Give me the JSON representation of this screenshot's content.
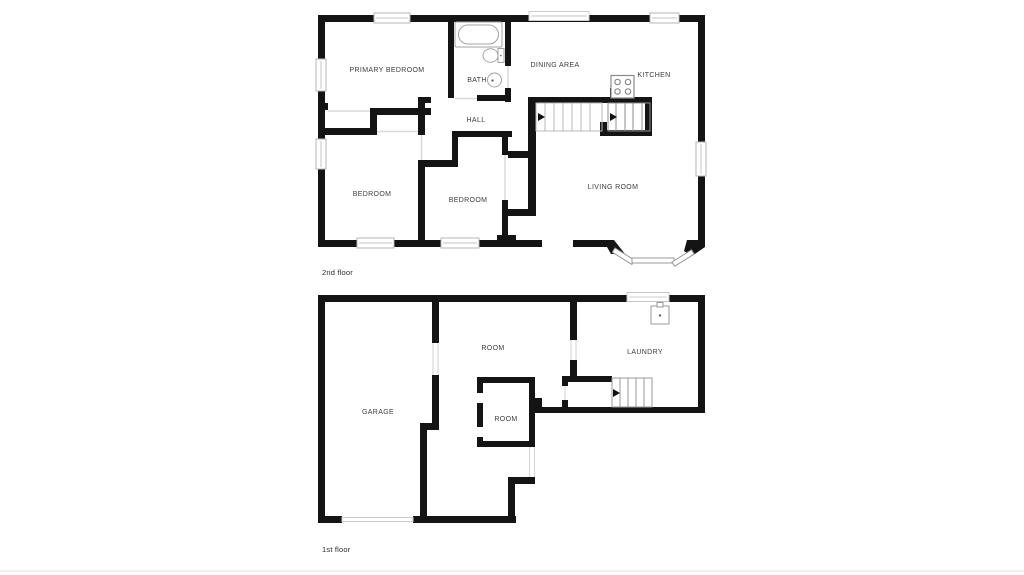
{
  "document_title": "Residential floor plan",
  "colors": {
    "wall": "#141414",
    "window_frame": "#b4b4b4",
    "light_window_frame": "#cccccc",
    "stair_line_light": "#b8b8b8",
    "stair_line_dark": "#8f8f8f",
    "door_swing_line": "#d8d8d8",
    "fixture_stroke": "#9a9a9a",
    "label_text": "#3c3c3c",
    "background": "#ffffff"
  },
  "floor2": {
    "caption": "2nd floor",
    "labels": {
      "primary_bedroom": "PRIMARY BEDROOM",
      "bath": "BATH",
      "dining": "DINING AREA",
      "kitchen": "KITCHEN",
      "hall": "HALL",
      "bedroom_left": "BEDROOM",
      "bedroom_center": "BEDROOM",
      "living_room": "LIVING ROOM"
    },
    "icons": [
      "bathtub-icon",
      "toilet-icon",
      "sink-icon",
      "stove-icon",
      "stairs-icon",
      "bay-window-icon",
      "window-icon"
    ]
  },
  "floor1": {
    "caption": "1st floor",
    "labels": {
      "garage": "GARAGE",
      "room_top": "ROOM",
      "room_inner": "ROOM",
      "laundry": "LAUNDRY"
    },
    "icons": [
      "washer-icon",
      "stairs-icon",
      "garage-door-icon",
      "window-icon"
    ]
  }
}
